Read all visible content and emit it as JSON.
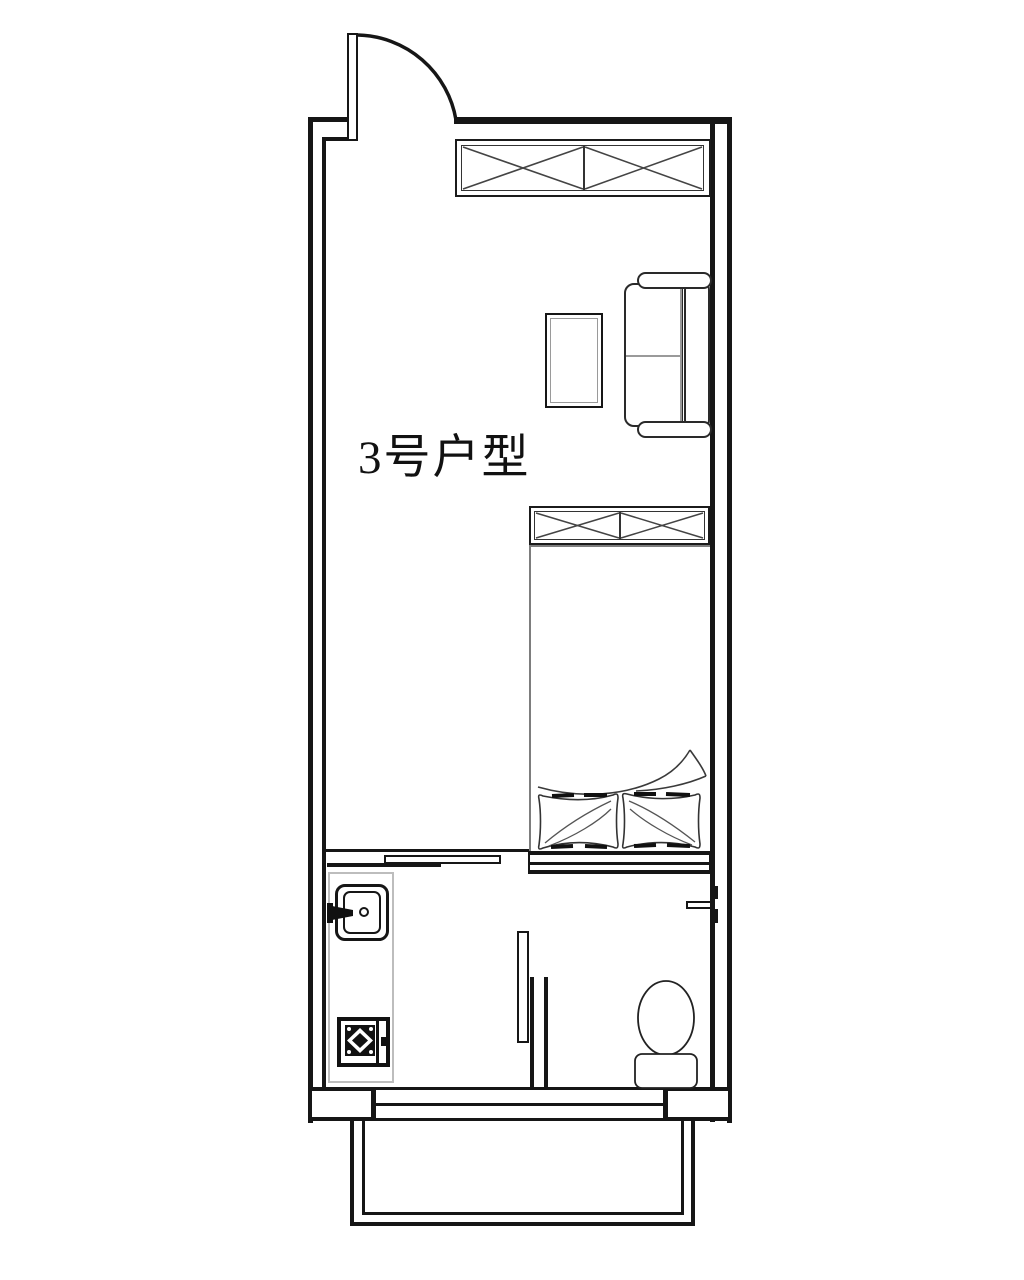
{
  "floor_plan": {
    "label": "3号户型"
  },
  "colors": {
    "line": "#161616",
    "furniture_gray": "#9a9a9a",
    "counter_gray": "#bdbdbd",
    "background": "#ffffff"
  },
  "fixtures": [
    "entry-door",
    "entry-door-swing-arc",
    "wardrobe-top",
    "coffee-table",
    "sofa",
    "wardrobe-bed",
    "bed",
    "pillows",
    "blanket-fold",
    "sliding-door",
    "kitchen-counter",
    "sink",
    "gas-stove",
    "shower-partition",
    "toilet",
    "bathroom-door",
    "bottom-window",
    "balcony"
  ]
}
